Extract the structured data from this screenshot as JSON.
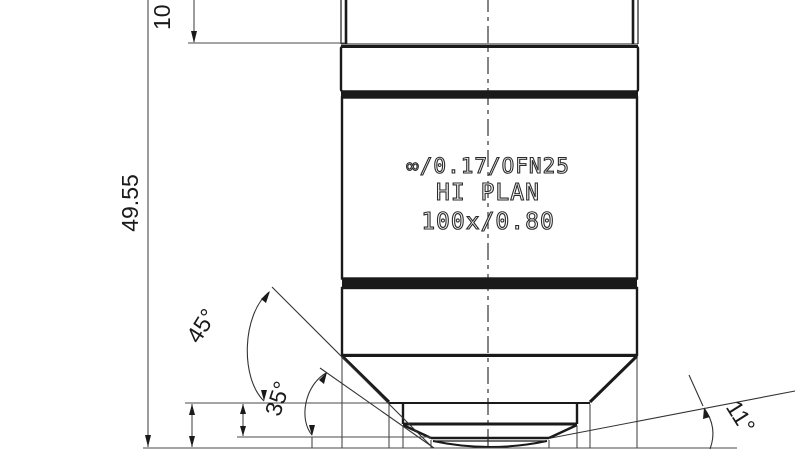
{
  "drawing": {
    "type": "technical-drawing",
    "subject": "microscope-objective-side-view",
    "background": "#ffffff",
    "line_color": "#1a1a1a"
  },
  "dimensions": {
    "overall_height": "49.55",
    "top_section_height": "10",
    "cone_angle_outer": "45°",
    "cone_angle_inner": "35°",
    "front_clearance_angle": "11°"
  },
  "engraving": {
    "line1": "∞/0.17/OFN25",
    "line2": "HI PLAN",
    "line3": "100x/0.80"
  }
}
